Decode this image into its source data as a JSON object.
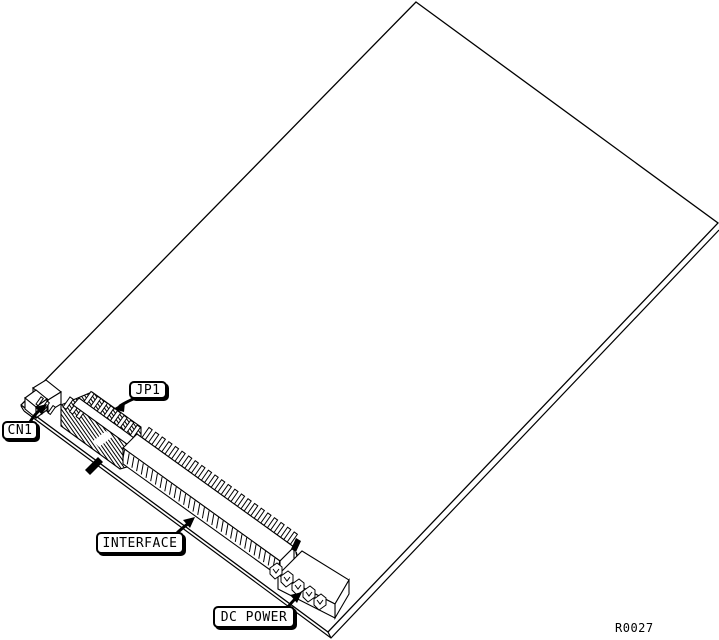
{
  "diagram": {
    "figure_ref": "R0027",
    "labels": {
      "cn1": "CN1",
      "jp1": "JP1",
      "interface": "INTERFACE",
      "dc_power": "DC POWER"
    },
    "colors": {
      "line": "#000000",
      "background": "#ffffff",
      "fill": "#ffffff"
    }
  }
}
